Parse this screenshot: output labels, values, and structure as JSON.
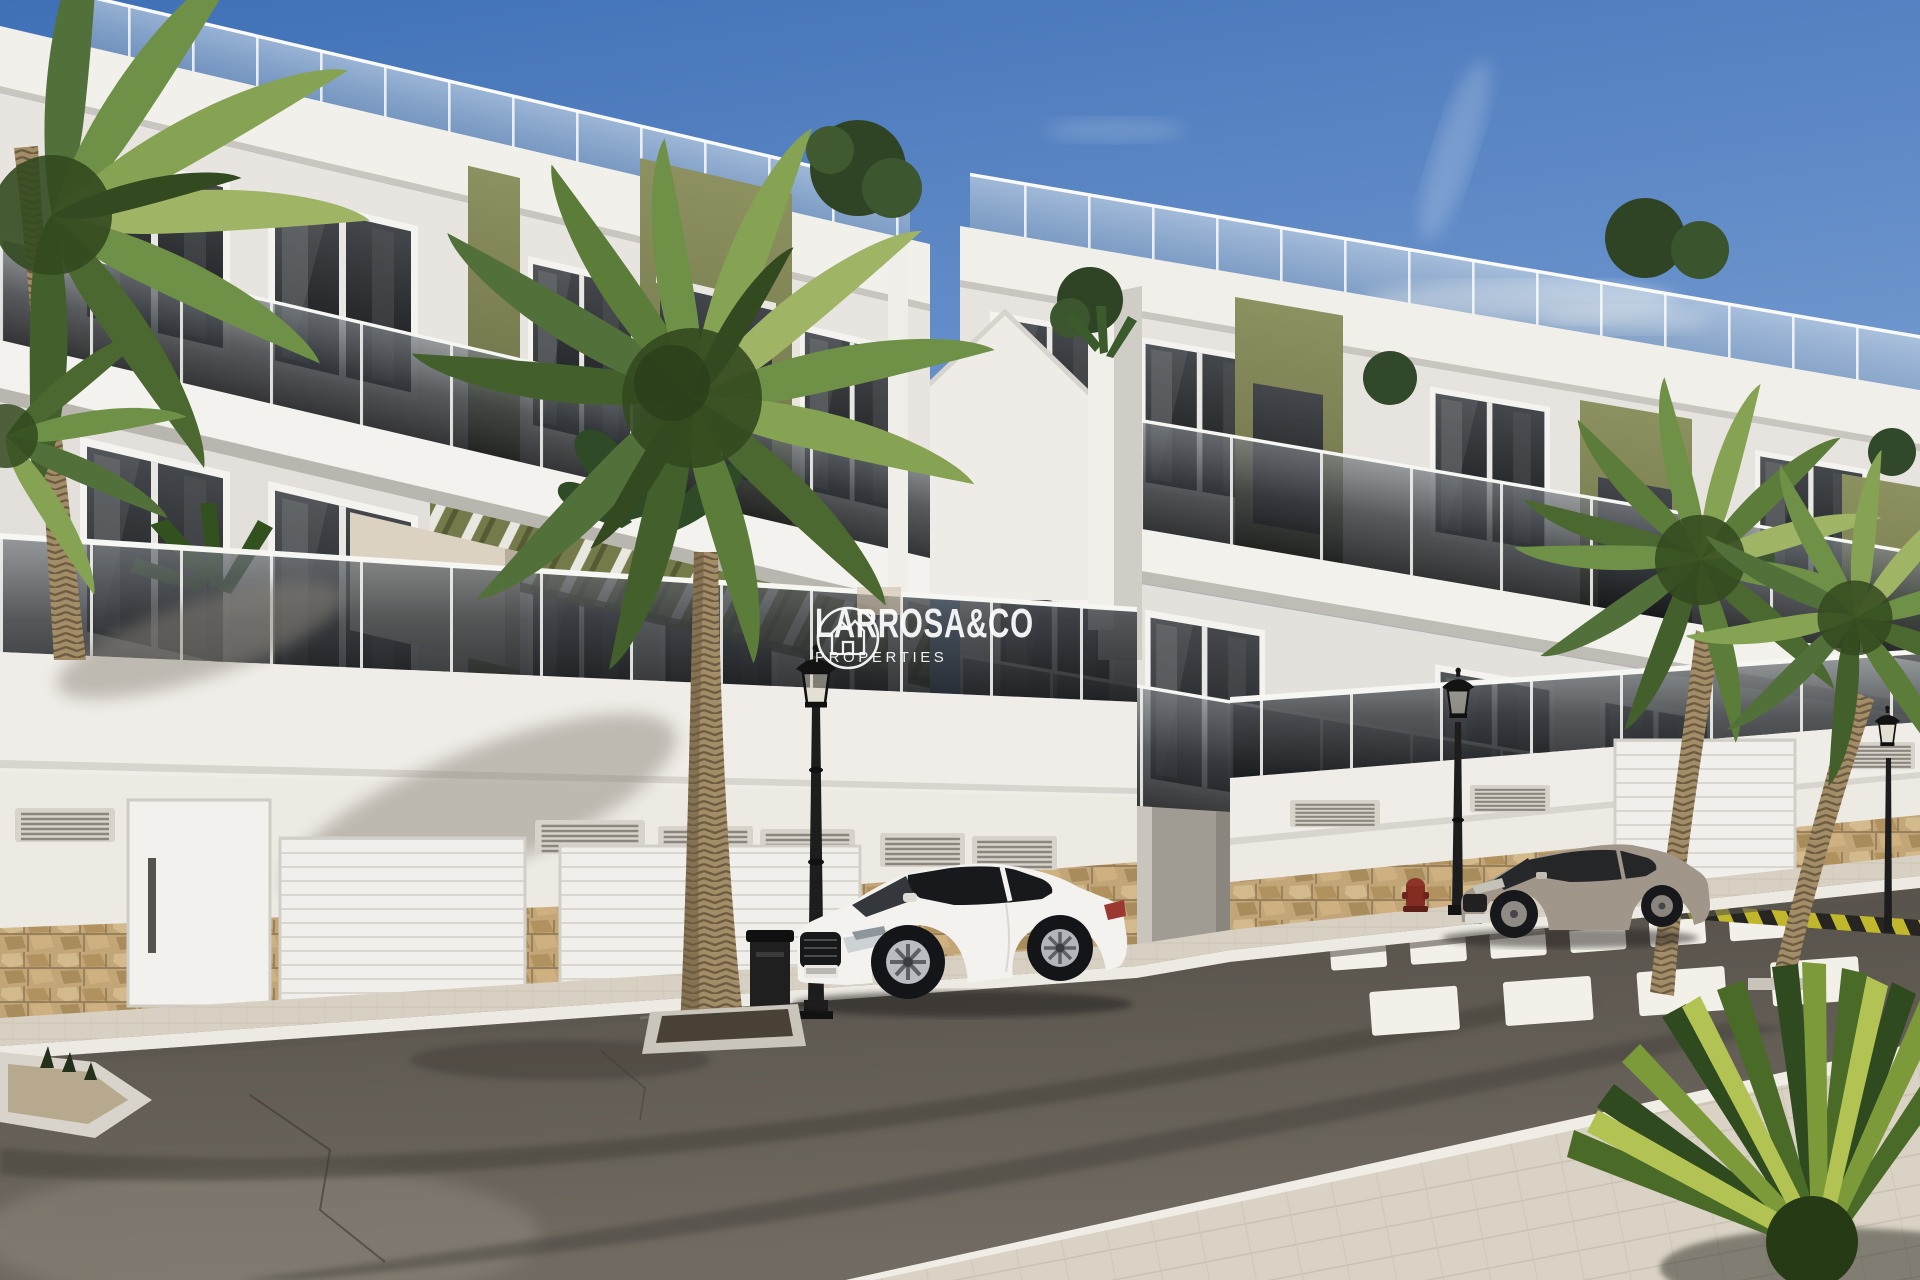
{
  "watermark": {
    "brand": "LARROSA&CO",
    "tagline": "PROPERTIES",
    "logo_icon": "house-monogram-circle-icon",
    "text_color": "#ffffff"
  },
  "palette": {
    "sky_top": "#3f70b6",
    "sky_mid": "#6d95cd",
    "sky_horizon": "#cfdeee",
    "facade_white": "#edeae5",
    "olive_accent_light": "#8d9160",
    "olive_accent_dark": "#696d44",
    "stone_base": "#c2a678",
    "sidewalk": "#d8d1c3",
    "asphalt_dark": "#514c45",
    "asphalt_light": "#716b62",
    "crosswalk_white": "#f2f0e8",
    "barrier_yellow": "#c0b72c",
    "palm_green": "#5d7d3b",
    "car_white_body": "#f3f2ef",
    "car_gray_body": "#a0968a",
    "glass_dark": "#1d2023",
    "hydrant_red": "#832c22"
  },
  "scene": {
    "type": "architectural-exterior-render",
    "objects": [
      "two white apartment buildings with olive-green accent panels",
      "glass balcony railings and rooftop terraces",
      "green pergola slats over ground-floor terraces",
      "stone-clad garage level with white sectional doors and vents",
      "five palm trees and balcony plants",
      "white sports coupe parked at curb",
      "gray coupe parked near crosswalk",
      "zebra crosswalk and yellow-black painted curb",
      "three ornate black street lamps, litter bin, red fire hydrant",
      "asphalt street with tire marks and paved foreground sidewalk"
    ]
  }
}
